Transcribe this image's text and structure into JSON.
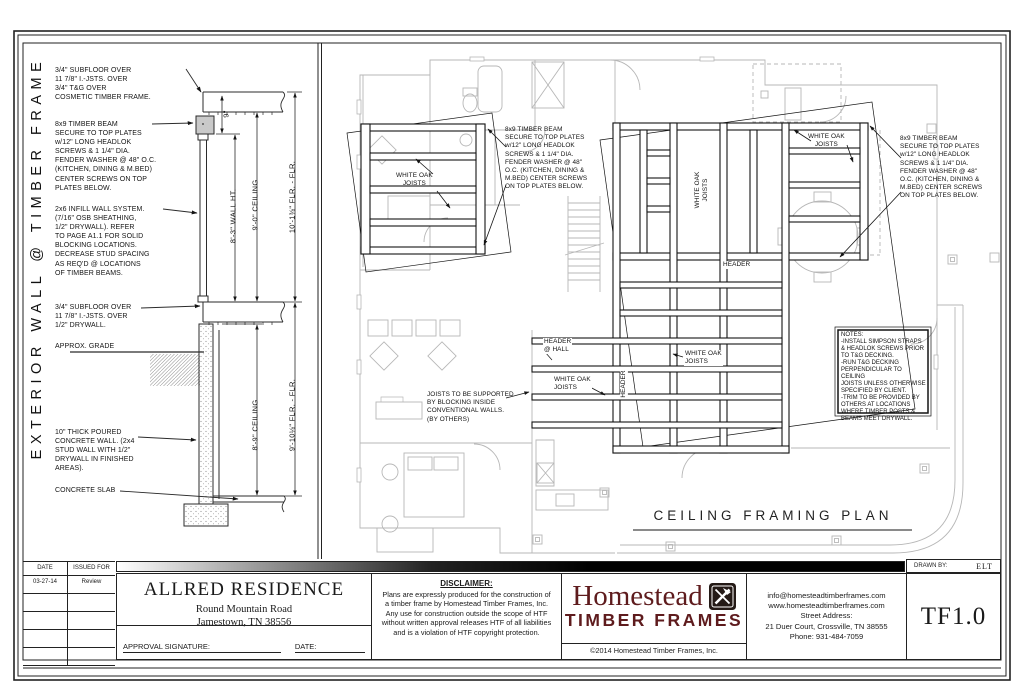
{
  "side_label": "EXTERIOR WALL @ TIMBER FRAME",
  "colors": {
    "line_dark": "#1a1a1a",
    "line_light": "#b9b9b9",
    "brand_red": "#5e1b1d"
  },
  "section": {
    "note_subfloor_upper": "3/4\" SUBFLOOR OVER\n11 7/8\" I.-JSTS. OVER\n3/4\" T&G OVER\nCOSMETIC TIMBER FRAME.",
    "note_timber_beam": "8x9 TIMBER BEAM\nSECURE TO TOP PLATES\nw/12\" LONG HEADLOK\nSCREWS & 1 1/4\" DIA.\nFENDER WASHER @ 48\" O.C.\n(KITCHEN, DINING & M.BED)\nCENTER SCREWS ON TOP\nPLATES BELOW.",
    "note_infill_wall": "2x6 INFILL WALL SYSTEM.\n(7/16\" OSB SHEATHING,\n1/2\" DRYWALL). REFER\nTO PAGE A1.1 FOR SOLID\nBLOCKING LOCATIONS.\nDECREASE STUD SPACING\nAS REQ'D @ LOCATIONS\nOF TIMBER BEAMS.",
    "note_subfloor_lower": "3/4\" SUBFLOOR OVER\n11 7/8\" I.-JSTS. OVER\n1/2\" DRYWALL.",
    "note_grade": "APPROX. GRADE",
    "note_concrete_wall": "10\" THICK POURED\nCONCRETE WALL. (2x4\nSTUD WALL WITH 1/2\"\nDRYWALL IN FINISHED\nAREAS).",
    "note_slab": "CONCRETE SLAB",
    "dim_9in": "9\"",
    "dim_wall_ht": "8'-3\" WALL HT.",
    "dim_ceiling_upper": "9'-0\" CEILING",
    "dim_flr_upper": "10'-1⅜\" FLR. - FLR.",
    "dim_ceiling_lower": "8'-9\" CEILING",
    "dim_flr_lower": "9'-10⅛\" FLR. - FLR."
  },
  "plan": {
    "title": "CEILING FRAMING PLAN",
    "label_white_oak": "WHITE OAK\nJOISTS",
    "beam_note_center": "8x9 TIMBER BEAM\nSECURE TO TOP PLATES\nw/12\" LONG HEADLOK\nSCREWS & 1 1/4\" DIA.\nFENDER WASHER @ 48\"\nO.C. (KITCHEN, DINING &\nM.BED) CENTER SCREWS\nON TOP PLATES BELOW.",
    "beam_note_right": "8x9 TIMBER BEAM\nSECURE TO TOP PLATES\nw/12\" LONG HEADLOK\nSCREWS & 1 1/4\" DIA.\nFENDER WASHER @ 48\"\nO.C. (KITCHEN, DINING &\nM.BED) CENTER SCREWS\nON TOP PLATES BELOW.",
    "label_header": "HEADER",
    "label_header_hall": "HEADER\n@ HALL",
    "joist_support_note": "JOISTS TO BE SUPPORTED\nBY BLOCKING INSIDE\nCONVENTIONAL WALLS.\n(BY OTHERS)",
    "notes_box": "NOTES:\n-INSTALL SIMPSON STRAPS\n& HEADLOK SCREWS PRIOR\nTO T&G DECKING.\n-RUN T&G DECKING\nPERPENDICULAR TO CEILING\nJOISTS UNLESS OTHERWISE\nSPECIFIED BY CLIENT.\n-TRIM TO BE PROVIDED BY\nOTHERS AT LOCATIONS\nWHERE TIMBER POSTS &\nBEAMS MEET DRYWALL."
  },
  "titleblock": {
    "date_header": "DATE",
    "issued_header": "ISSUED FOR",
    "rev_date": "03-27-14",
    "rev_issued": "Review",
    "project": "ALLRED RESIDENCE",
    "address1": "Round Mountain Road",
    "address2": "Jamestown, TN 38556",
    "approval_label": "APPROVAL SIGNATURE:",
    "approval_date_label": "DATE:",
    "disclaimer_title": "DISCLAIMER:",
    "disclaimer_body": "Plans are expressly produced for the construction of a timber frame by Homestead Timber Frames, Inc. Any use for construction outside the scope of HTF without written approval releases HTF of all liabilities and is a violation of HTF copyright protection.",
    "logo_name": "Homestead",
    "logo_sub": "TIMBER FRAMES",
    "copyright": "©2014 Homestead Timber Frames, Inc.",
    "contact": "info@homesteadtimberframes.com\nwww.homesteadtimberframes.com\nStreet Address:\n21 Duer Court, Crossville, TN 38555\nPhone: 931-484-7059",
    "drawn_by_label": "DRAWN BY:",
    "drawn_by": "ELT",
    "sheet_number": "TF1.0"
  }
}
